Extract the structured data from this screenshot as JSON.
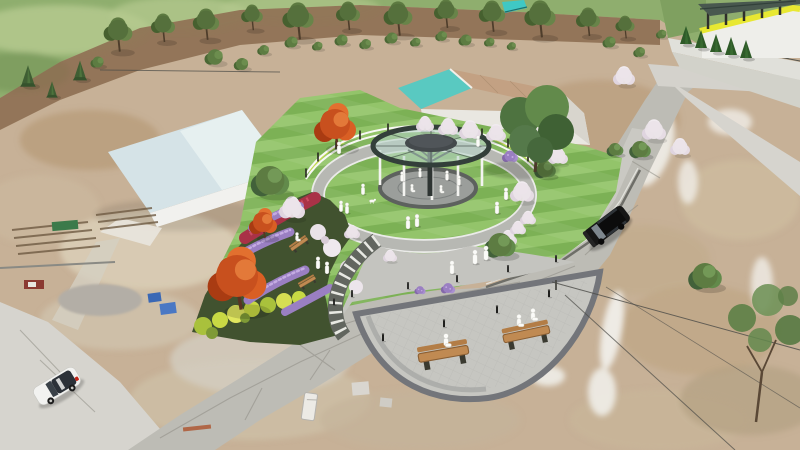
{
  "scene": {
    "title": "Aerial 3D architectural render of a circular pocket park with central glass-ring pavilion, flower gardens, bench plaza, roads and surrounding rural terrain"
  },
  "palette": {
    "terrain_base": "#c7b197",
    "terrain_light": "#ded2bc",
    "strip_brown": "#8d6f52",
    "field_green": "#8fae6e",
    "field_light": "#b6ca90",
    "tree_green": "#55703c",
    "bush_green": "#5d7c42",
    "conifer_green": "#3f5e33",
    "road_gray": "#bdbcb5",
    "road_light": "#d6d4ce",
    "road_crack": "#8e8c84",
    "gutter_dark": "#6e6e68",
    "sidewalk": "#cac9c3",
    "lawn_a": "#7cb155",
    "lawn_b": "#93c46a",
    "ring_path": "#b7b8b3",
    "ring_edge": "#ebebe9",
    "pad_gray": "#9b9e9b",
    "pad_ring": "#5d615e",
    "canopy_rim": "#333f3a",
    "canopy_glass": "#b9d6ca",
    "canopy_disc": "#44494c",
    "column_white": "#f4f4f1",
    "trunk_dark": "#2e3432",
    "fence_white": "#f8f8f4",
    "fence_post": "#26261f",
    "fence_glow": "#c8da4b",
    "soil_dark": "#41522f",
    "shrub_yellow": "#c8d944",
    "lavender": "#9a7fc2",
    "lavender_light": "#c4abe2",
    "crimson": "#a93247",
    "blossom_white": "#ebe4e9",
    "autumn_red": "#c8501e",
    "steps_dark": "#62665f",
    "steps_white": "#eff0ea",
    "plaza_fill": "#c6c6c1",
    "plaza_ring": "#73757a",
    "entry_plaza": "#c4c4bf",
    "bench_wood": "#c08a52",
    "bollard": "#1f1f1d",
    "suv_black": "#161616",
    "suv_glass": "#8a939b",
    "car_white": "#f2f2f0",
    "car_glass": "#2c3138",
    "car_tail": "#c22418",
    "roof_left_blue": "#d5e3e7",
    "roof_left_light": "#eaf2f3",
    "wall_white": "#f1f1ee",
    "roof_teal": "#59c9c1",
    "roof_tan": "#c3a183",
    "corner_wall": "#eeeeea",
    "corner_band": "#e8e832",
    "pergola_dark": "#49584f",
    "cone_green": "#2e5a28",
    "terrace_gray": "#e0e0da",
    "teal_struct": "#3fc8c4",
    "figure_white": "#fbfbf8",
    "wire": "#4a4a46",
    "tarp_blue": "#3a68b5",
    "plank_red": "#b06747",
    "snow_white": "#f0eee9"
  },
  "instances": {
    "tree-top": [
      [
        118,
        30,
        1.2
      ],
      [
        163,
        24,
        1
      ],
      [
        206,
        20,
        1.1
      ],
      [
        252,
        14,
        0.9
      ],
      [
        298,
        16,
        1.3
      ],
      [
        348,
        12,
        1
      ],
      [
        398,
        14,
        1.2
      ],
      [
        446,
        10,
        1
      ],
      [
        492,
        12,
        1.1
      ],
      [
        540,
        14,
        1.3
      ],
      [
        588,
        18,
        1
      ],
      [
        625,
        24,
        0.8
      ]
    ],
    "bush": [
      [
        215,
        57,
        1.4
      ],
      [
        242,
        64,
        1.1
      ],
      [
        264,
        50,
        0.9
      ],
      [
        292,
        42,
        1
      ],
      [
        318,
        46,
        0.8
      ],
      [
        342,
        40,
        1
      ],
      [
        366,
        44,
        0.9
      ],
      [
        392,
        38,
        1
      ],
      [
        416,
        42,
        0.8
      ],
      [
        442,
        36,
        0.9
      ],
      [
        466,
        40,
        1
      ],
      [
        490,
        42,
        0.8
      ],
      [
        512,
        46,
        0.7
      ],
      [
        98,
        62,
        1
      ],
      [
        610,
        42,
        1
      ],
      [
        640,
        52,
        0.9
      ],
      [
        662,
        34,
        0.8
      ]
    ],
    "conifer": [
      [
        28,
        82,
        1.2
      ],
      [
        52,
        94,
        0.9
      ],
      [
        80,
        76,
        1.1
      ]
    ],
    "tree-red": [
      [
        335,
        124,
        1.5
      ],
      [
        237,
        276,
        2.1
      ],
      [
        263,
        222,
        1
      ]
    ],
    "blossom": [
      [
        292,
        208,
        1.3
      ],
      [
        448,
        127,
        1
      ],
      [
        470,
        130,
        1.1
      ],
      [
        496,
        133,
        1
      ],
      [
        425,
        124,
        0.9
      ],
      [
        522,
        192,
        1.2
      ],
      [
        558,
        156,
        1
      ],
      [
        624,
        76,
        1.1
      ],
      [
        654,
        130,
        1.2
      ],
      [
        680,
        147,
        1
      ],
      [
        352,
        232,
        0.8
      ],
      [
        390,
        256,
        0.7
      ],
      [
        508,
        238,
        0.9
      ],
      [
        518,
        228,
        0.8
      ],
      [
        528,
        218,
        0.8
      ]
    ],
    "green-bush": [
      [
        500,
        246,
        1.3
      ],
      [
        640,
        150,
        0.9
      ],
      [
        705,
        277,
        1.4
      ],
      [
        270,
        182,
        1.6
      ],
      [
        545,
        170,
        0.9
      ],
      [
        615,
        150,
        0.7
      ]
    ],
    "cone": [
      [
        686,
        44,
        1
      ],
      [
        701,
        48,
        1
      ],
      [
        716,
        52,
        1
      ],
      [
        731,
        55,
        1
      ],
      [
        746,
        58,
        1
      ]
    ],
    "purple-patch": [
      [
        510,
        156,
        1
      ],
      [
        448,
        288,
        0.9
      ],
      [
        532,
        148,
        0.7
      ],
      [
        420,
        290,
        0.7
      ]
    ],
    "bench": [
      [
        444,
        357,
        2.8,
        -10
      ],
      [
        527,
        337,
        2.6,
        -12
      ],
      [
        300,
        245,
        1.1,
        -35
      ],
      [
        308,
        283,
        1,
        -30
      ]
    ],
    "bollard": [
      [
        334,
        305,
        0.9
      ],
      [
        352,
        297,
        0.9
      ],
      [
        408,
        289,
        0.9
      ],
      [
        457,
        282,
        0.9
      ],
      [
        508,
        272,
        0.9
      ],
      [
        556,
        262,
        0.9
      ],
      [
        383,
        341,
        1
      ],
      [
        444,
        327,
        1
      ],
      [
        497,
        313,
        1
      ],
      [
        549,
        297,
        1
      ]
    ],
    "fence-post": [
      [
        306,
        177,
        1
      ],
      [
        318,
        161,
        1
      ],
      [
        336,
        149,
        1
      ],
      [
        360,
        139,
        1
      ],
      [
        388,
        132,
        1
      ],
      [
        420,
        129,
        1
      ],
      [
        452,
        131,
        1
      ],
      [
        482,
        137,
        1
      ],
      [
        508,
        147,
        1
      ],
      [
        528,
        161,
        1
      ],
      [
        540,
        173,
        1
      ]
    ],
    "person-stand": [
      [
        363,
        193,
        1
      ],
      [
        341,
        210,
        1
      ],
      [
        347,
        212,
        1
      ],
      [
        408,
        227,
        1.15
      ],
      [
        417,
        225,
        1.15
      ],
      [
        475,
        262,
        1.3
      ],
      [
        486,
        258,
        1.3
      ],
      [
        506,
        198,
        1.1
      ],
      [
        497,
        212,
        1.1
      ],
      [
        318,
        267,
        1.1
      ],
      [
        327,
        272,
        1.1
      ],
      [
        339,
        152,
        1.1
      ],
      [
        478,
        145,
        1
      ],
      [
        452,
        272,
        1.2
      ],
      [
        402,
        180,
        0.9
      ],
      [
        447,
        179,
        0.9
      ],
      [
        459,
        184,
        0.9
      ],
      [
        420,
        176,
        0.85
      ]
    ],
    "person-sit": [
      [
        446,
        345,
        1.5
      ],
      [
        519,
        325,
        1.4
      ],
      [
        533,
        319,
        1.4
      ],
      [
        297,
        240,
        1
      ],
      [
        412,
        191,
        0.9
      ],
      [
        441,
        192,
        0.9
      ]
    ],
    "dog": [
      [
        372,
        201,
        1
      ]
    ]
  }
}
